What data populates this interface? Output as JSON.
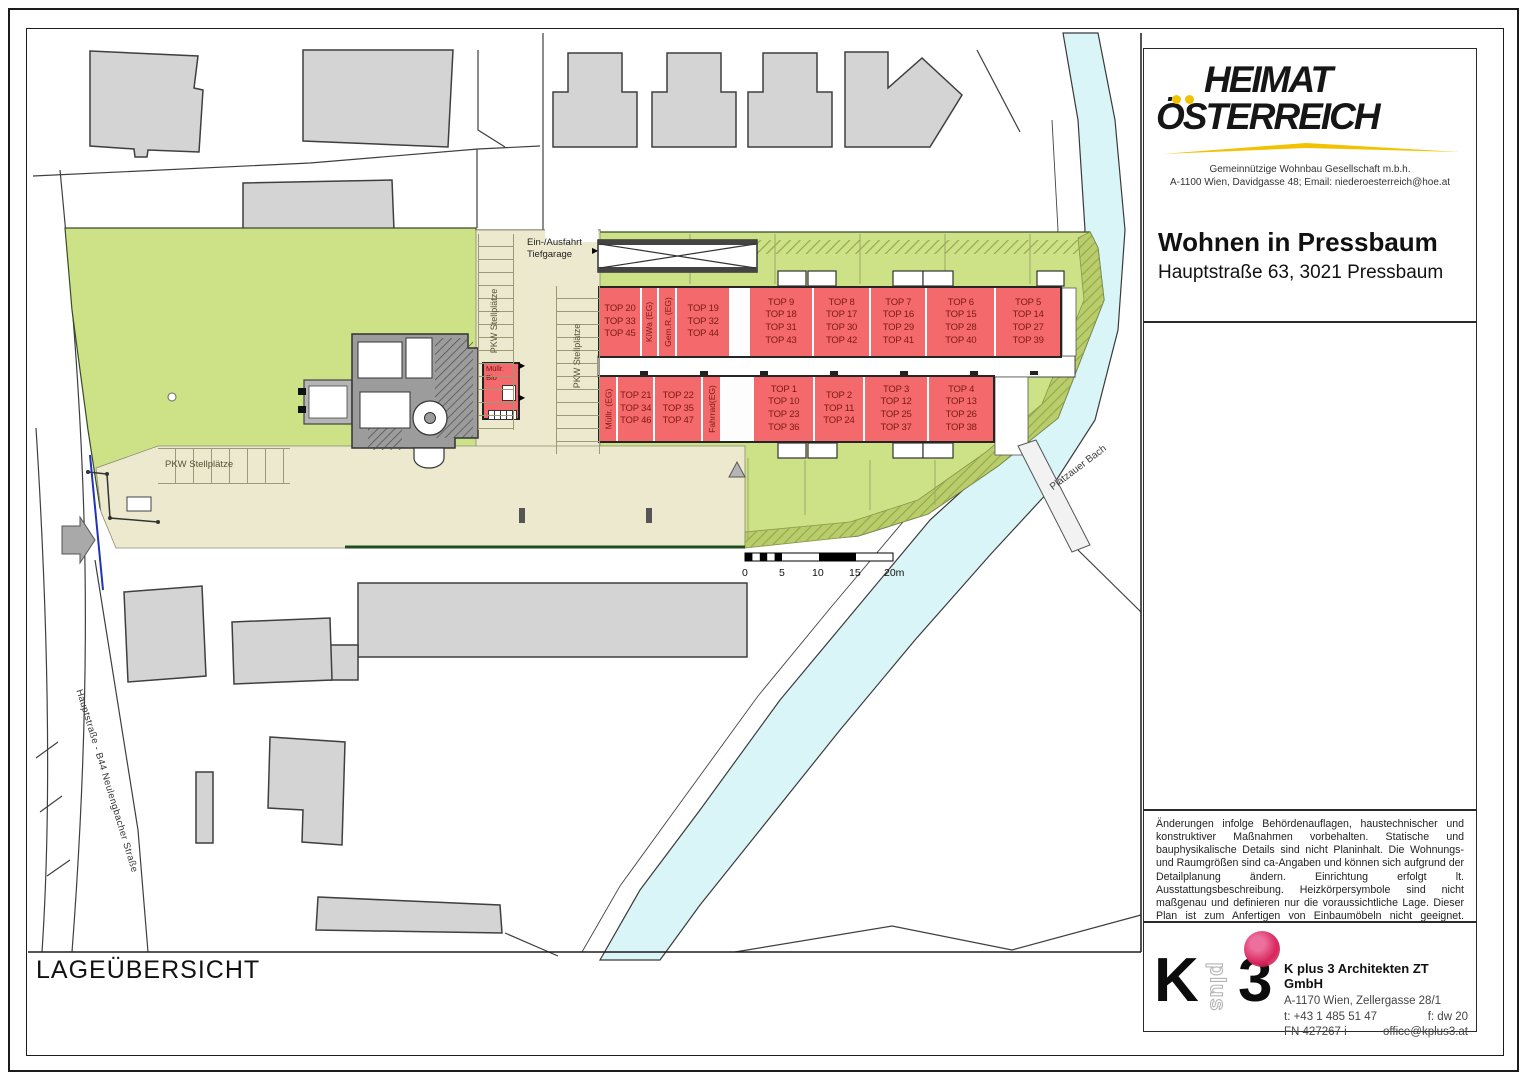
{
  "header": {
    "logo_line1": "HEIMAT",
    "logo_line2": "ÖSTERREICH",
    "org_line1": "Gemeinnützige Wohnbau Gesellschaft m.b.h.",
    "org_line2": "A-1100 Wien, Davidgasse 48; Email: niederoesterreich@hoe.at",
    "project_title": "Wohnen in Pressbaum",
    "project_address": "Hauptstraße 63, 3021 Pressbaum",
    "accent_yellow": "#F2C200"
  },
  "map_labels": {
    "garage": "Ein-/Ausfahrt\nTiefgarage",
    "parking_left": "PKW Stellplätze",
    "parking_mid": "PKW Stellplätze",
    "parking_bottom": "PKW Stellplätze",
    "street": "Hauptstraße - B44 Neulengbacher Straße",
    "stream": "Platzauer Bach",
    "sheet_title": "LAGEÜBERSICHT"
  },
  "scale_bar": {
    "ticks": [
      "0",
      "5",
      "10",
      "15",
      "20m"
    ]
  },
  "outbuilding": {
    "label": "Müllr.\nBio",
    "ar": "AR"
  },
  "upper_building": {
    "cells": [
      {
        "kind": "unit",
        "label": "TOP 20\nTOP 33\nTOP 45"
      },
      {
        "kind": "room",
        "label": "KiWa (EG)"
      },
      {
        "kind": "room",
        "label": "Gem.R. (EG)"
      },
      {
        "kind": "unit",
        "label": "TOP 19\nTOP 32\nTOP 44"
      },
      {
        "kind": "gap",
        "label": ""
      },
      {
        "kind": "unit",
        "label": "TOP 9\nTOP 18\nTOP 31\nTOP 43"
      },
      {
        "kind": "unit",
        "label": "TOP 8\nTOP 17\nTOP 30\nTOP 42"
      },
      {
        "kind": "unit",
        "label": "TOP 7\nTOP 16\nTOP 29\nTOP 41"
      },
      {
        "kind": "unit",
        "label": "TOP 6\nTOP 15\nTOP 28\nTOP 40"
      },
      {
        "kind": "unit",
        "label": "TOP 5\nTOP 14\nTOP 27\nTOP 39"
      }
    ]
  },
  "lower_building": {
    "cells": [
      {
        "kind": "room",
        "label": "Müllr. (EG)"
      },
      {
        "kind": "unit",
        "label": "TOP 21\nTOP 34\nTOP 46"
      },
      {
        "kind": "unit",
        "label": "TOP 22\nTOP 35\nTOP 47"
      },
      {
        "kind": "room",
        "label": "Fahrrad(EG)"
      },
      {
        "kind": "gap",
        "label": ""
      },
      {
        "kind": "unit",
        "label": "TOP 1\nTOP 10\nTOP 23\nTOP 36"
      },
      {
        "kind": "unit",
        "label": "TOP 2\nTOP 11\nTOP 24"
      },
      {
        "kind": "unit",
        "label": "TOP 3\nTOP 12\nTOP 25\nTOP 37"
      },
      {
        "kind": "unit",
        "label": "TOP 4\nTOP 13\nTOP 26\nTOP 38"
      }
    ]
  },
  "disclaimer": {
    "text": "Änderungen infolge Behördenauflagen, haustechnischer und konstruktiver Maßnahmen vorbehalten. Statische und bauphysikalische Details sind nicht Planinhalt. Die Wohnungs- und Raumgrößen sind ca-Angaben und können sich aufgrund der Detailplanung ändern. Einrichtung erfolgt lt. Ausstattungsbeschreibung. Heizkörpersymbole sind nicht maßgenau und definieren nur die voraussichtliche Lage. Dieser Plan ist zum Anfertigen von Einbaumöbeln nicht geeignet. Naturmaße nehmen!"
  },
  "architect": {
    "logo_k": "K",
    "logo_plus": "plus",
    "logo_3": "3",
    "name": "K plus 3 Architekten ZT GmbH",
    "address": "A-1170 Wien, Zellergasse 28/1",
    "phone": "t:  +43 1 485 51 47",
    "fax": "f: dw 20",
    "register": "FN 427267 i",
    "email": "office@kplus3.at"
  },
  "colors": {
    "unit_red": "#F4696B",
    "site_green": "#CDE287",
    "embankment_green": "#B9CE6B",
    "water_blue": "#DAF5F8",
    "parking_beige": "#ECE9CF",
    "neighbor_gray": "#D4D4D4",
    "stamp_pink": "#D8255C"
  }
}
